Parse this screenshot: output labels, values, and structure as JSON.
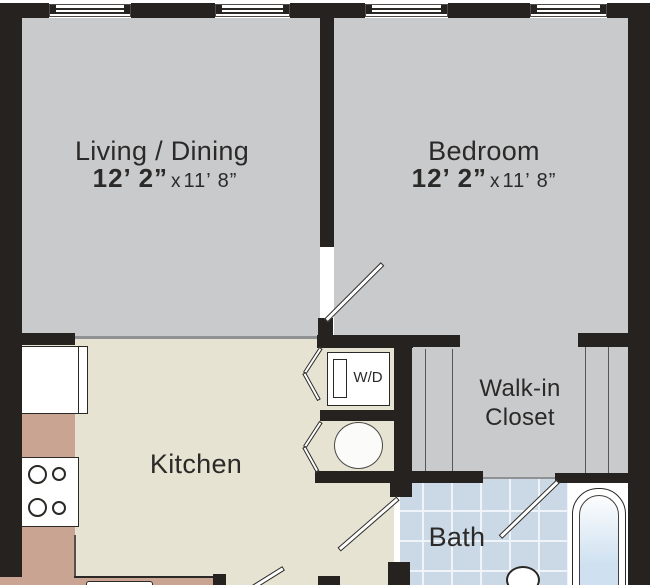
{
  "rooms": {
    "living_dining": {
      "label": "Living / Dining",
      "dim_primary": "12’ 2”",
      "dim_separator": "x",
      "dim_secondary": "11’ 8”"
    },
    "bedroom": {
      "label": "Bedroom",
      "dim_primary": "12’ 2”",
      "dim_separator": "x",
      "dim_secondary": "11’ 8”"
    },
    "kitchen": {
      "label": "Kitchen"
    },
    "walk_in_closet": {
      "label_line1": "Walk-in",
      "label_line2": "Closet"
    },
    "bath": {
      "label": "Bath"
    },
    "laundry_closet": {
      "label": "W/D"
    }
  },
  "colors": {
    "wall": "#262220",
    "floor_room": "#c9cacc",
    "floor_kitchen": "#e6e3d2",
    "counter": "#c9a493",
    "tile": "#cbd9e7",
    "tile_grout": "#eef4f9",
    "tub_fill": "#cfe1f0",
    "fixture_outline": "#2b2926",
    "shelf_line": "#56575b",
    "boundary_line": "#8f9193",
    "text": "#2c2a28",
    "background": "#ffffff"
  }
}
